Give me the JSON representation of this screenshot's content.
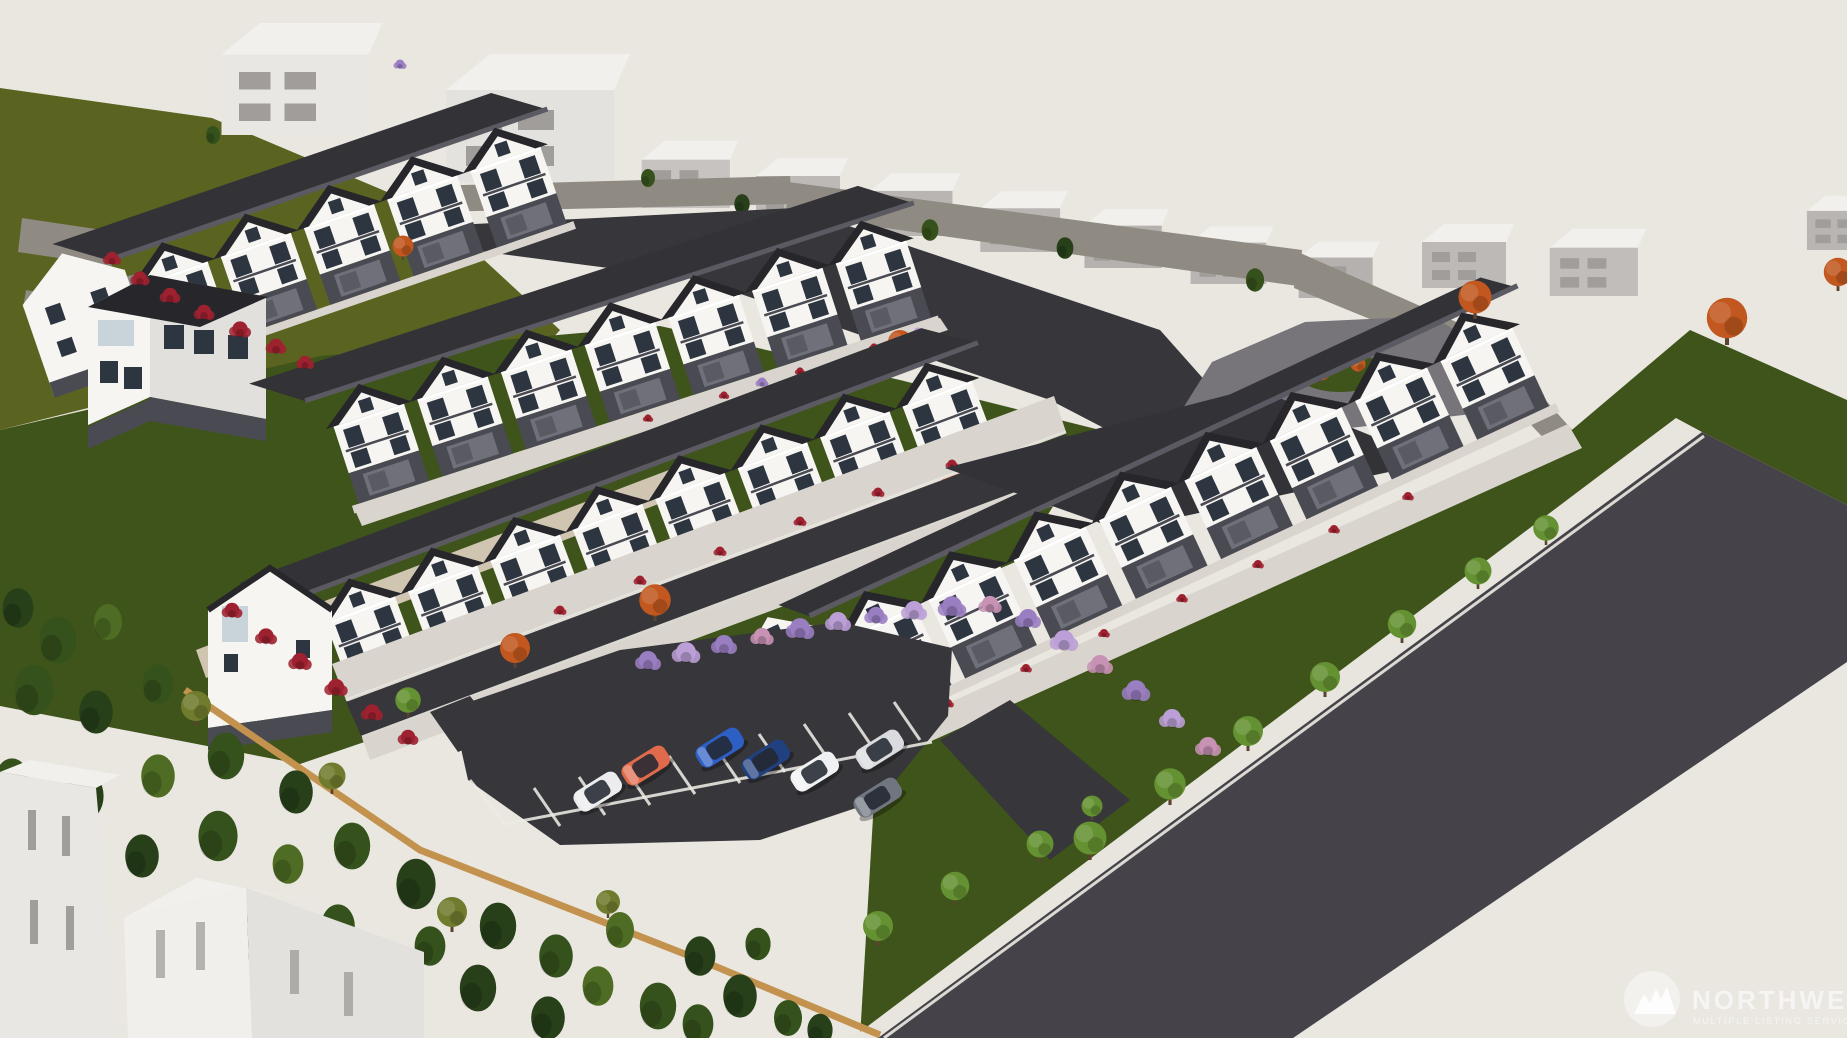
{
  "watermark": {
    "brand": "NORTHWEST",
    "tagline": "MULTIPLE LISTING SERVICE",
    "logo": "mountain-circle-icon"
  },
  "scene": {
    "description": "Aerial 3D architectural rendering of a new townhome community: rows of white townhouses with dark gable roofs, a long three-story condo building along a diagonal road, central parking lot with cars, evergreen forest and wood fence at lower left, rock retaining walls and gray context houses uphill, autumn and purple landscaping",
    "parking_cars": [
      {
        "label": "white SUV",
        "color": "#ececee"
      },
      {
        "label": "orange coupe",
        "color": "#e06a4c"
      },
      {
        "label": "blue sedan",
        "color": "#2d5fc4"
      },
      {
        "label": "navy sedan",
        "color": "#20407f"
      },
      {
        "label": "white sedan",
        "color": "#f0f1f3"
      },
      {
        "label": "silver coupe",
        "color": "#d9dbde"
      },
      {
        "label": "gray sports car",
        "color": "#6f7680"
      }
    ],
    "upper_cars": [
      {
        "label": "yellow compact",
        "color": "#e7d06a"
      },
      {
        "label": "blue compact",
        "color": "#4a80d2"
      },
      {
        "label": "teal compact",
        "color": "#84c6da"
      }
    ],
    "counts": {
      "townhouse_rows": 4,
      "context_houses": 12,
      "parking_cars": 7,
      "upper_cars": 3
    }
  },
  "palette": {
    "ground": "#eae7e1",
    "lawn_olive": "#5a6420",
    "lawn_dark": "#3f541b",
    "asphalt_road": "#454349",
    "asphalt_street": "#37363a",
    "asphalt_light": "#77747a",
    "concrete": "#d9d5ce",
    "concrete_bright": "#e8e5de",
    "roof_dark": "#26262b",
    "roof_mid": "#323237",
    "roof_ridge": "#5b5a62",
    "siding": "#f6f5f2",
    "siding_shade": "#e2e0dc",
    "base_dark": "#4a4a53",
    "garage": "#70707a",
    "glass": "#2d3540",
    "glass_light": "#c9d3da",
    "massing_white": "#e9e7e3",
    "massing_gray": "#b8b5b3",
    "massing_roof": "#f2f0ec",
    "massing_win": "#a09d9a",
    "rock": "#8f8a82",
    "rock_pale": "#cfc5b0",
    "fence": "#c2924e",
    "evergreen_dark": "#27401a",
    "evergreen": "#35521d",
    "evergreen_light": "#4e6c23",
    "olive_tree": "#707b2d",
    "tree_green": "#649131",
    "tree_autumn": "#c2581f",
    "shrub_red": "#9e2130",
    "shrub_purple": "#9a7ec2",
    "shrub_purple_light": "#bb9fd6",
    "shrub_pink": "#c792b4",
    "trunk": "#5a4330",
    "watermark": "#ffffff"
  }
}
